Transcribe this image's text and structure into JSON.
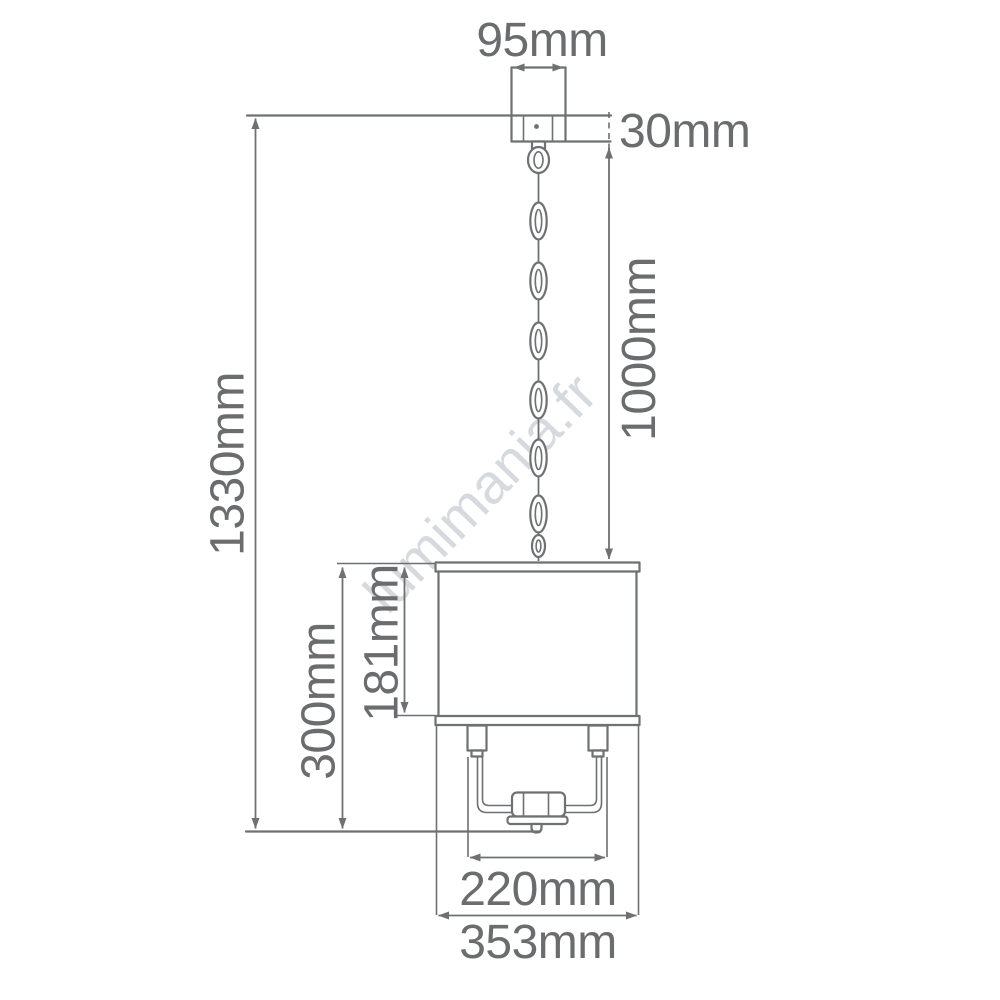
{
  "diagram": {
    "title": "pendant-light-dimension-diagram",
    "watermark": "lumimania.fr",
    "colors": {
      "background": "#ffffff",
      "line": "#6e7072",
      "text": "#6a6c6e",
      "watermark": "#cdd2d6"
    },
    "labels": {
      "canopy_width": "95mm",
      "canopy_height": "30mm",
      "chain_length": "1000mm",
      "overall_height": "1330mm",
      "shade_height": "181mm",
      "body_height": "300mm",
      "inner_width": "220mm",
      "shade_width": "353mm"
    }
  }
}
